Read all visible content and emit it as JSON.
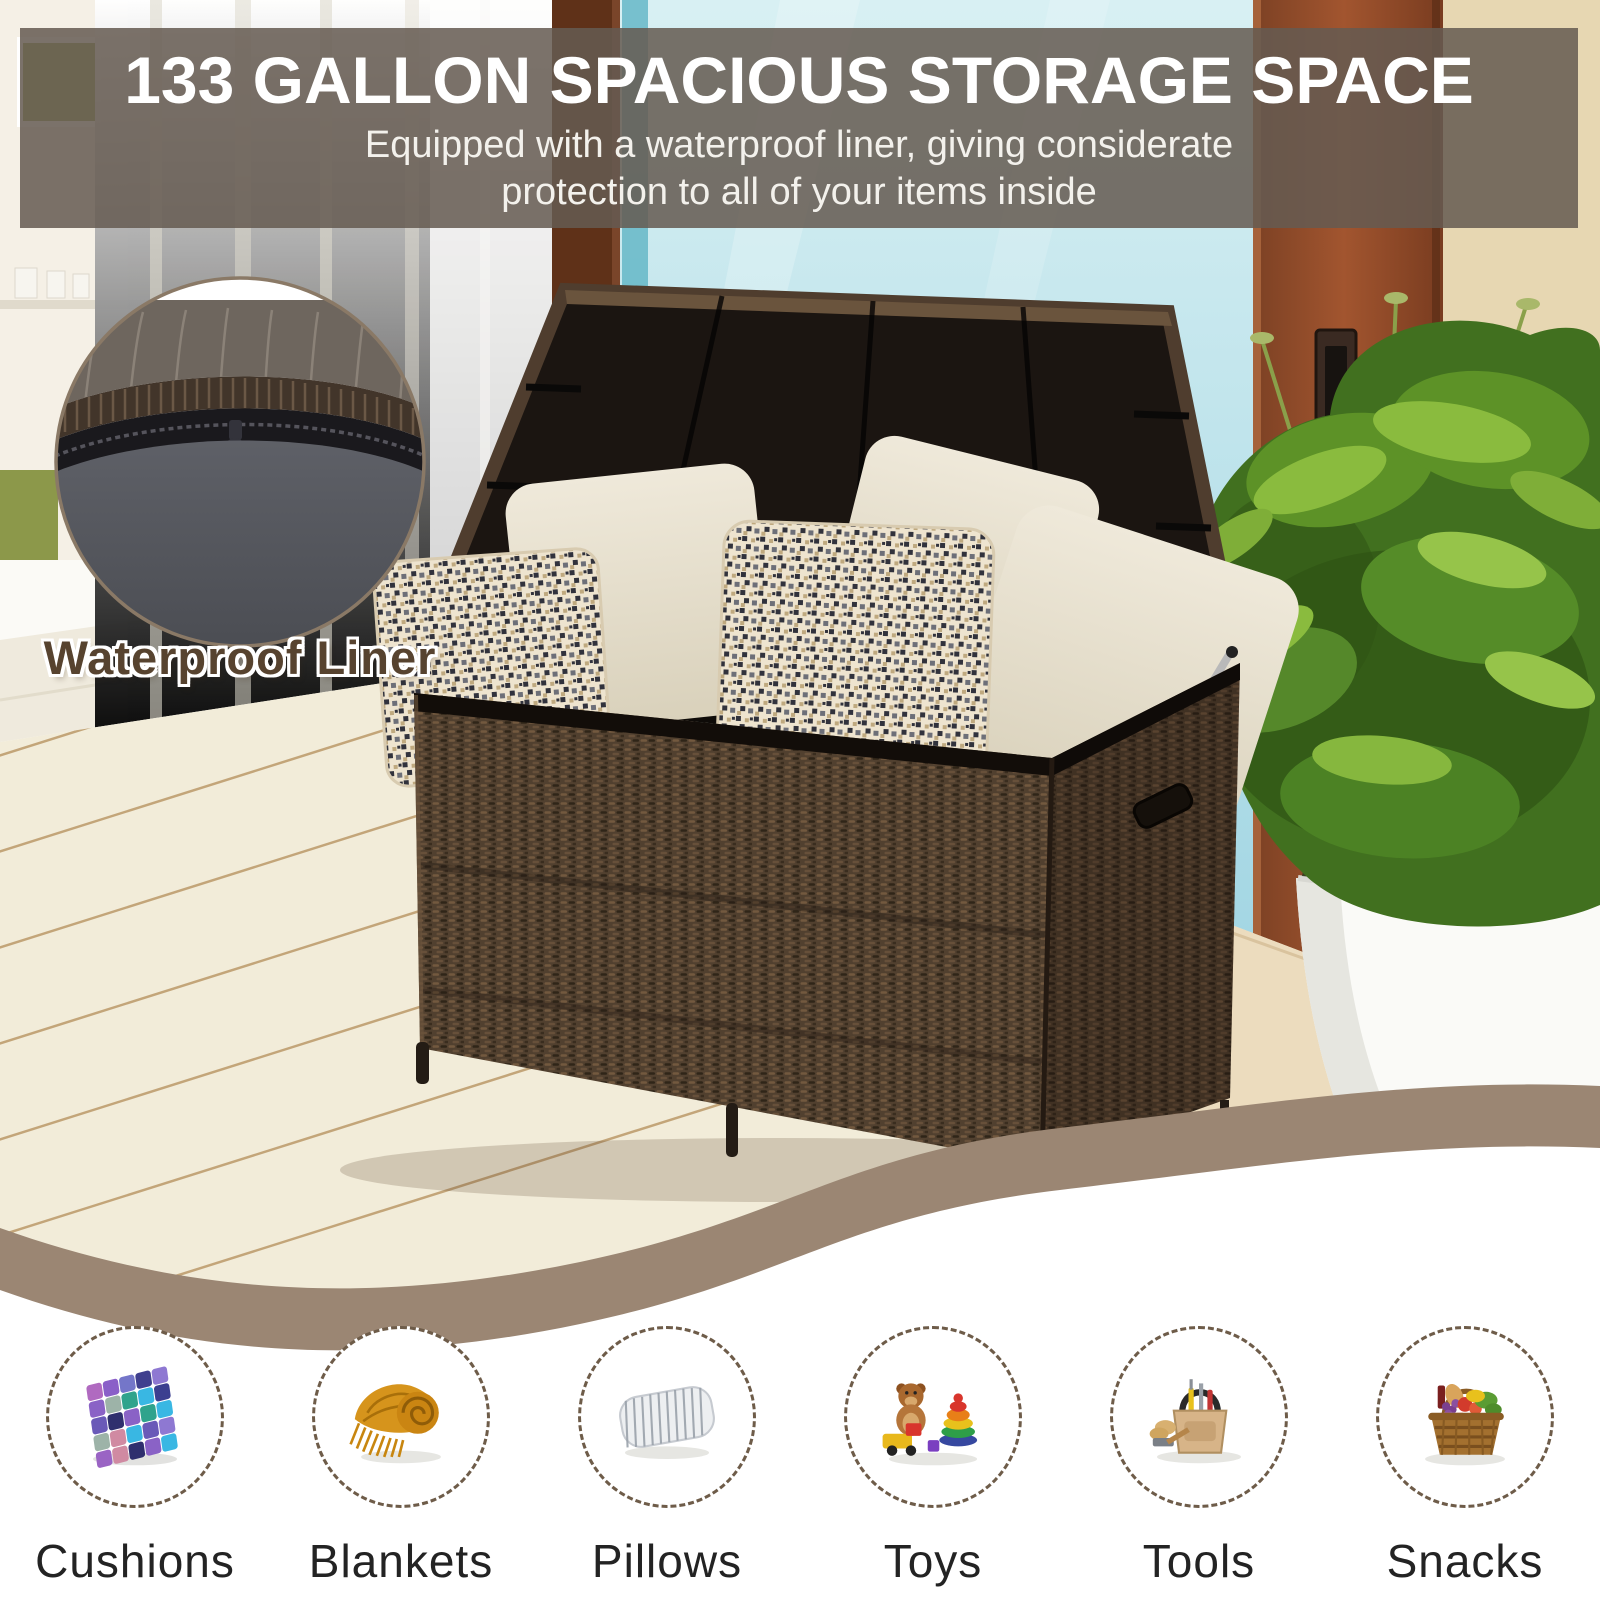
{
  "header": {
    "title": "133 GALLON SPACIOUS STORAGE SPACE",
    "subtitle_line1": "Equipped with a waterproof liner, giving considerate",
    "subtitle_line2": "protection to all of your items inside"
  },
  "callout": {
    "label": "Waterproof Liner"
  },
  "items": [
    {
      "label": "Cushions",
      "icon": "cushion-icon"
    },
    {
      "label": "Blankets",
      "icon": "blanket-icon"
    },
    {
      "label": "Pillows",
      "icon": "pillow-icon"
    },
    {
      "label": "Toys",
      "icon": "toys-icon"
    },
    {
      "label": "Tools",
      "icon": "tools-icon"
    },
    {
      "label": "Snacks",
      "icon": "snacks-icon"
    }
  ],
  "colors": {
    "header_overlay": "#655b52",
    "headline_text": "#ffffff",
    "wave_band": "#9b8673",
    "dashed_circle_border": "#6e5c49",
    "icon_label_text": "#232323",
    "callout_text": "#57432f",
    "wicker_brown": "#51402f",
    "liner_gray": "#565860"
  }
}
